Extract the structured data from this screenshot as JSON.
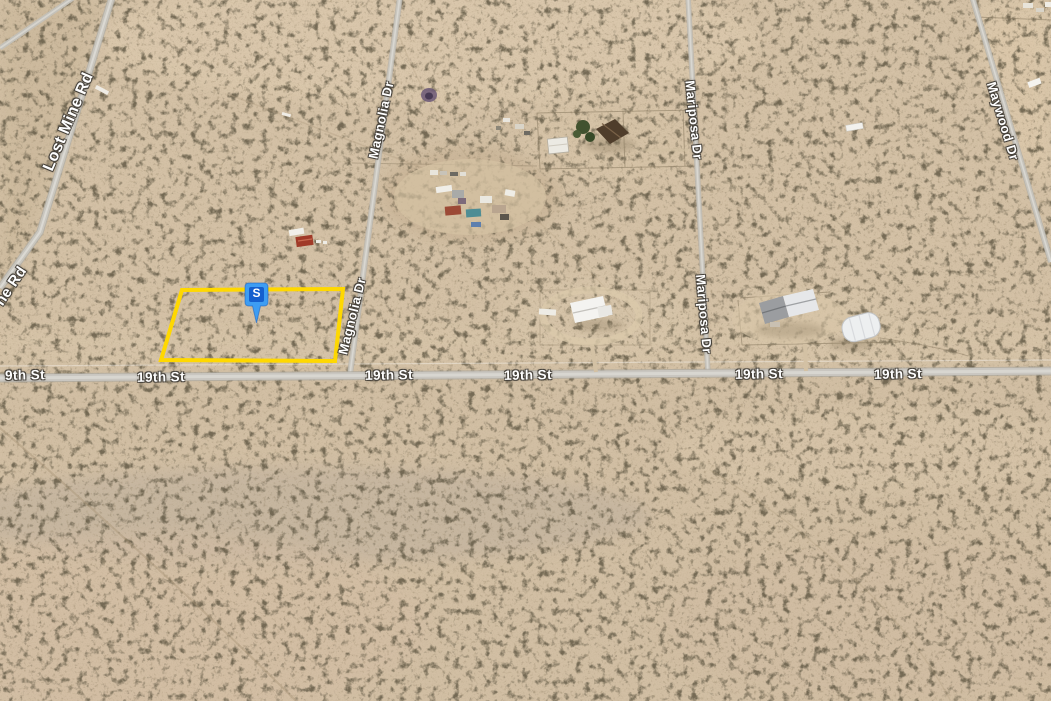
{
  "map": {
    "view": "satellite-desert-parcels",
    "road_labels": {
      "lost_mine": "Lost Mine Rd",
      "lost_mine_partial": "ne Rd",
      "magnolia_1": "Magnolia Dr",
      "magnolia_2": "Magnolia Dr",
      "mariposa_1": "Mariposa Dr",
      "mariposa_2": "Mariposa Dr",
      "maywood": "Maywood Dr",
      "st19_0": "9th St",
      "st19_1": "19th St",
      "st19_2": "19th St",
      "st19_3": "19th St",
      "st19_4": "19th St",
      "st19_5": "19th St"
    },
    "marker": {
      "label": "S",
      "fill": "#3d9df3",
      "inner_fill": "#145fce",
      "label_color": "#ffffff"
    },
    "parcel": {
      "points": "182,290 343,289 335,361 161,360",
      "stroke": "#ffd800"
    },
    "colors": {
      "terrain": "#d2bfa4",
      "road": "#c6c3bb",
      "road_center": "#d8d6d0",
      "label_text": "#ffffff",
      "label_halo": "#423e37"
    }
  }
}
